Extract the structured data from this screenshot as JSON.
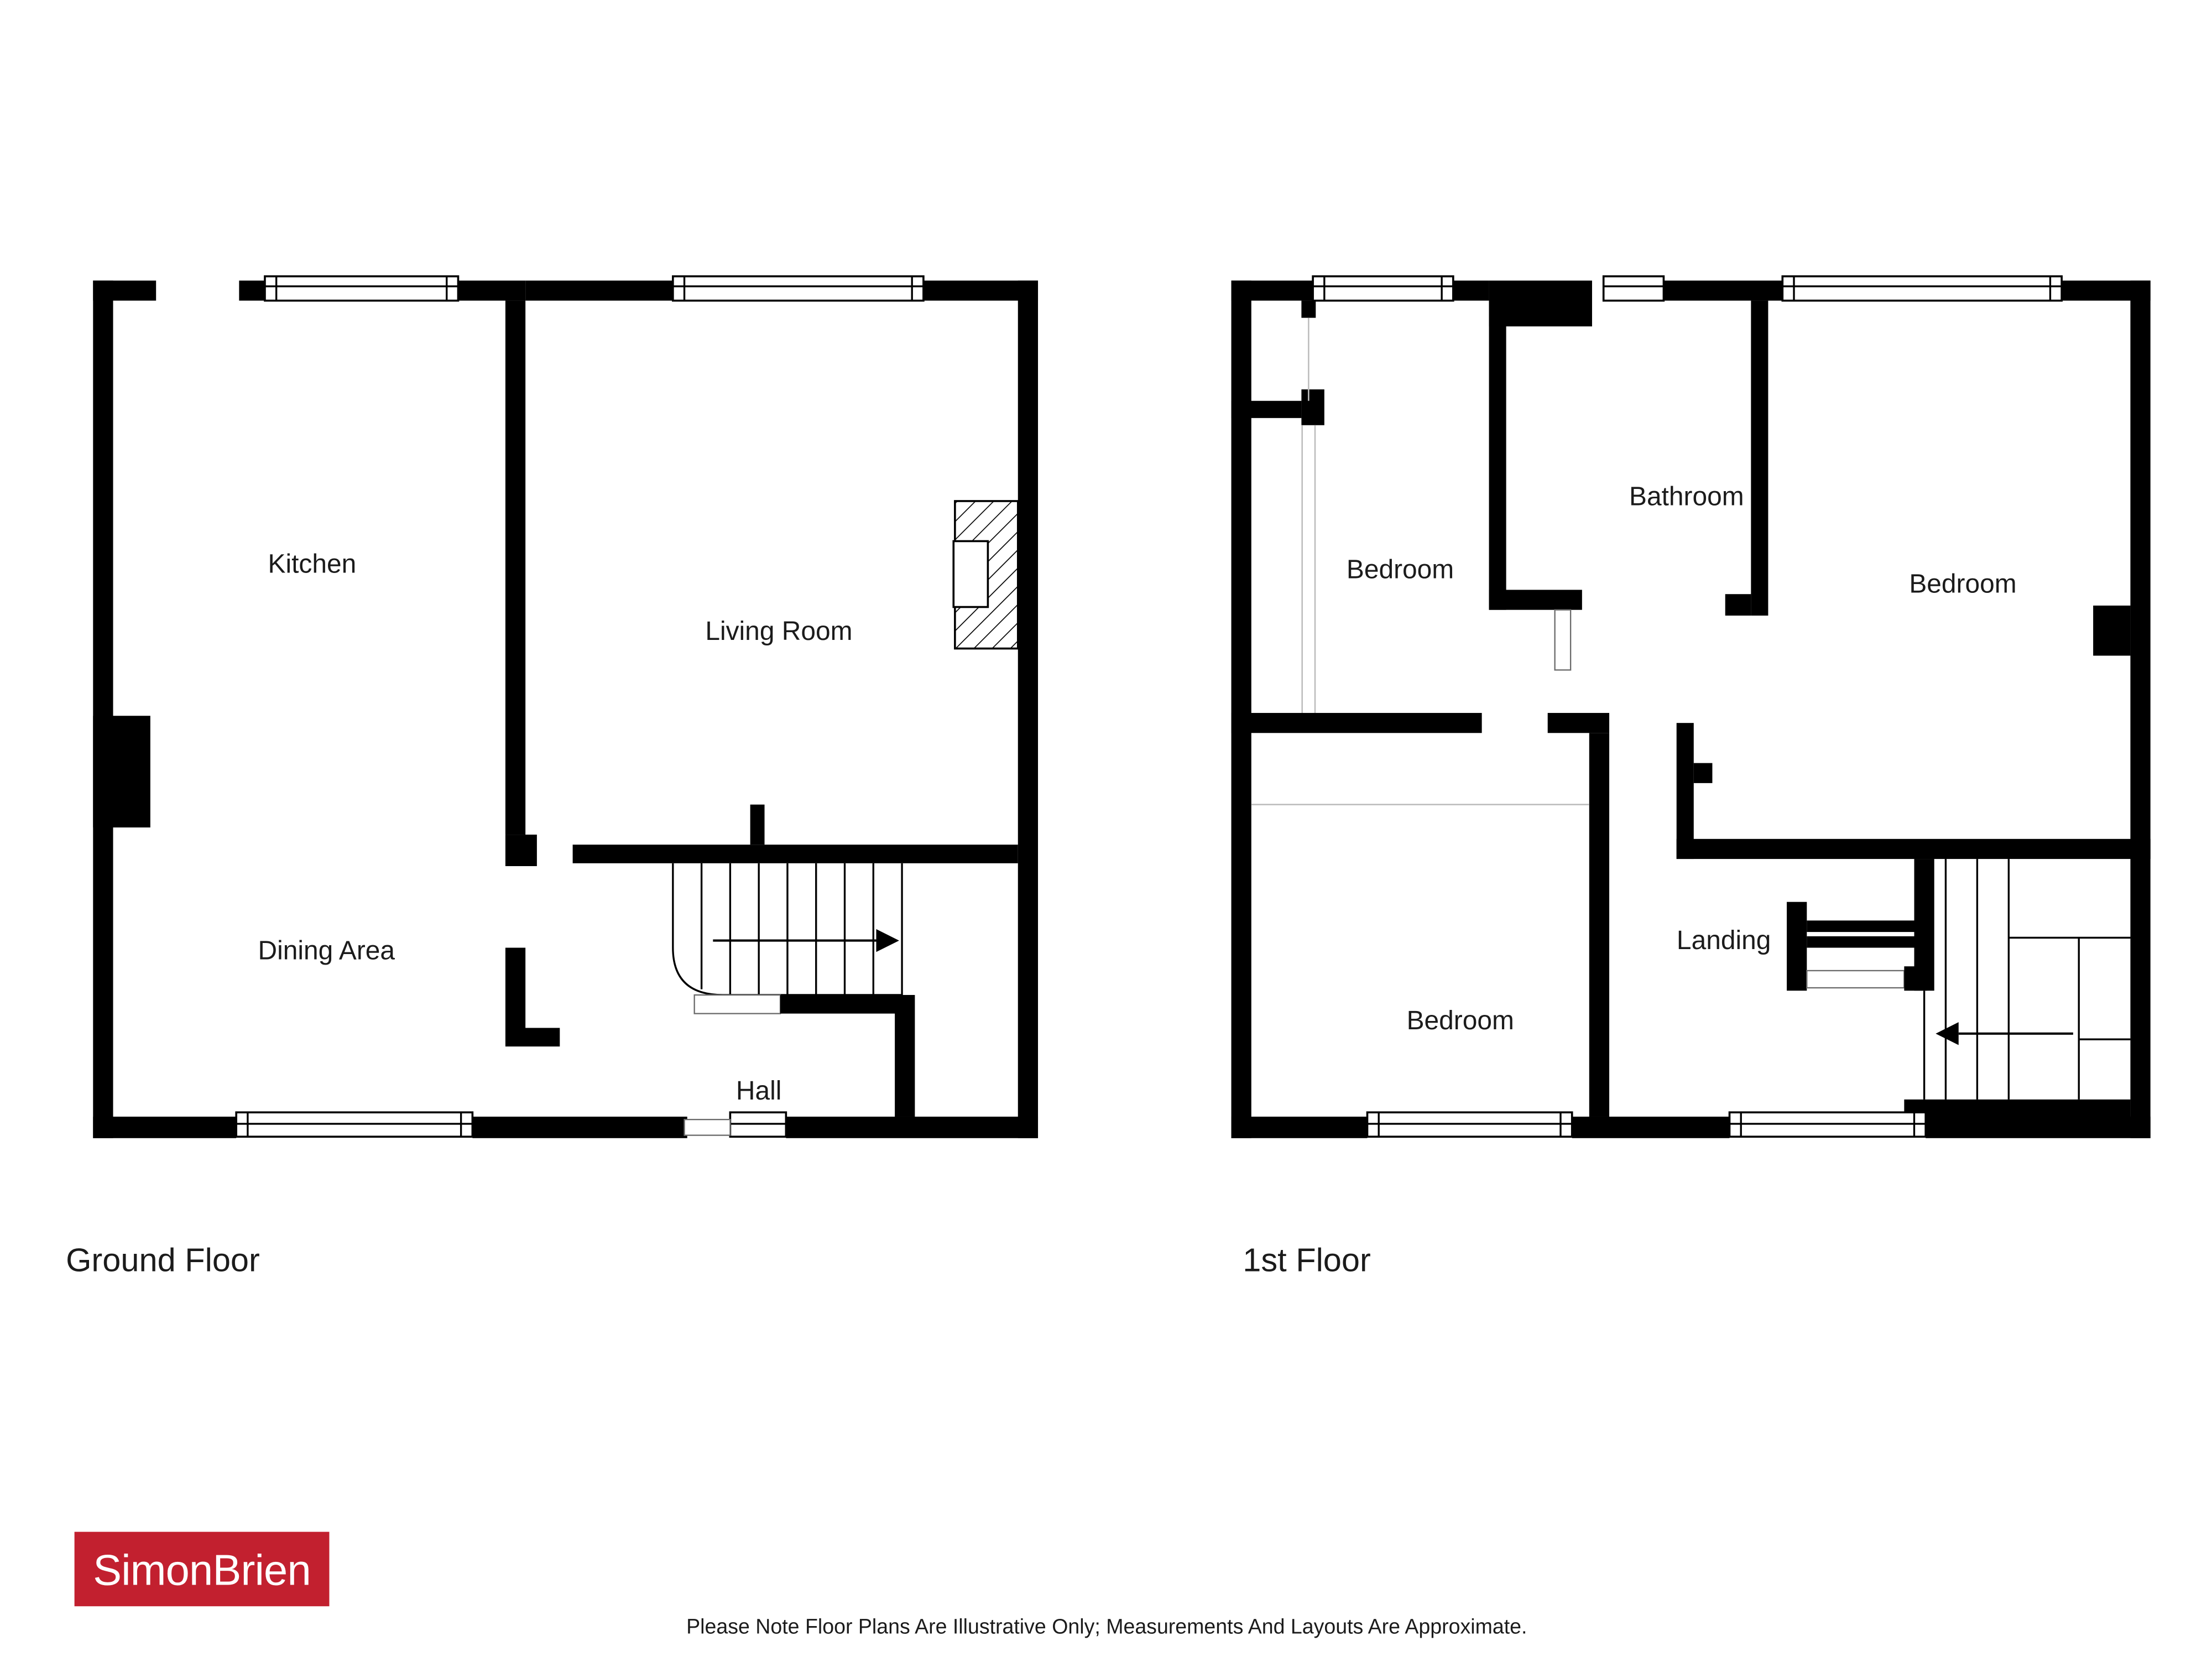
{
  "floors": {
    "ground": {
      "caption": "Ground Floor",
      "rooms": {
        "kitchen": "Kitchen",
        "living_room": "Living Room",
        "dining_area": "Dining Area",
        "hall": "Hall"
      }
    },
    "first": {
      "caption": "1st Floor",
      "rooms": {
        "bedroom_top_left": "Bedroom",
        "bathroom": "Bathroom",
        "bedroom_right": "Bedroom",
        "bedroom_bottom": "Bedroom",
        "landing": "Landing"
      }
    }
  },
  "branding": {
    "logo_text": "SimonBrien",
    "logo_background": "#c2202f",
    "logo_text_color": "#ffffff"
  },
  "footer": {
    "disclaimer": "Please Note Floor Plans Are Illustrative Only; Measurements And Layouts Are Approximate."
  },
  "colors": {
    "wall": "#000000",
    "hint_line": "#bdbdbd",
    "label_text": "#1b1b1b"
  }
}
